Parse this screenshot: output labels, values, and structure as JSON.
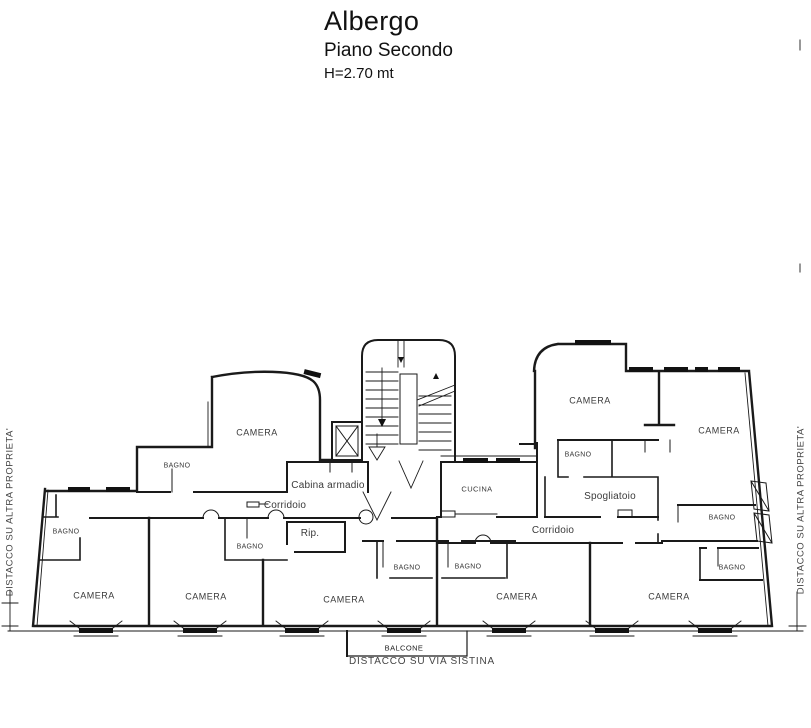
{
  "title": {
    "line1": "Albergo",
    "line2": "Piano Secondo",
    "line3": "H=2.70 mt"
  },
  "boundaries": {
    "left": "DISTACCO SU ALTRA PROPRIETA'",
    "right": "DISTACCO SU ALTRA PROPRIETA'",
    "bottom": "DISTACCO SU VIA SISTINA"
  },
  "balcony": {
    "label": "BALCONE"
  },
  "rooms": [
    {
      "id": "camera-1",
      "label": "CAMERA"
    },
    {
      "id": "bagno-1",
      "label": "BAGNO"
    },
    {
      "id": "cabina-armadio",
      "label": "Cabina armadio"
    },
    {
      "id": "corridoio-1",
      "label": "Corridoio"
    },
    {
      "id": "bagno-2",
      "label": "BAGNO"
    },
    {
      "id": "bagno-3",
      "label": "BAGNO"
    },
    {
      "id": "ripostiglio",
      "label": "Rip."
    },
    {
      "id": "camera-2",
      "label": "CAMERA"
    },
    {
      "id": "camera-3",
      "label": "CAMERA"
    },
    {
      "id": "camera-4",
      "label": "CAMERA"
    },
    {
      "id": "cucina",
      "label": "CUCINA"
    },
    {
      "id": "corridoio-2",
      "label": "Corridoio"
    },
    {
      "id": "bagno-4",
      "label": "BAGNO"
    },
    {
      "id": "bagno-5",
      "label": "BAGNO"
    },
    {
      "id": "camera-5",
      "label": "CAMERA"
    },
    {
      "id": "camera-6",
      "label": "CAMERA"
    },
    {
      "id": "bagno-6",
      "label": "BAGNO"
    },
    {
      "id": "spogliatoio",
      "label": "Spogliatoio"
    },
    {
      "id": "camera-7",
      "label": "CAMERA"
    },
    {
      "id": "bagno-7",
      "label": "BAGNO"
    },
    {
      "id": "bagno-8",
      "label": "BAGNO"
    },
    {
      "id": "camera-8",
      "label": "CAMERA"
    }
  ],
  "colors": {
    "background": "#ffffff",
    "line": "#1a1a1a",
    "text": "#3a3a3a"
  }
}
